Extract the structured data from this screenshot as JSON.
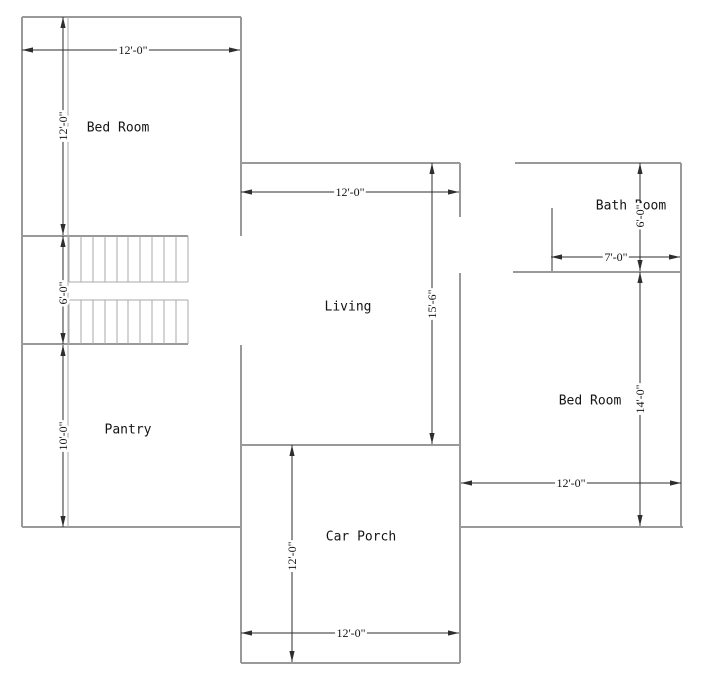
{
  "plan": {
    "rooms": {
      "bed_left": "Bed Room",
      "pantry": "Pantry",
      "living": "Living",
      "car_porch": "Car Porch",
      "bath": "Bath Room",
      "bed_right": "Bed Room"
    },
    "dims": {
      "top_left_width": "12'-0\"",
      "bed_left_height": "12'-0\"",
      "stairs_height": "6'-0\"",
      "pantry_height": "10'-0\"",
      "living_width": "12'-0\"",
      "living_height": "15'-6\"",
      "bath_height": "6'-0\"",
      "bath_width": "7'-0\"",
      "bed_right_height": "14'-0\"",
      "bed_right_width": "12'-0\"",
      "car_porch_height": "12'-0\"",
      "car_porch_width": "12'-0\""
    },
    "colors": {
      "wall": "#999999",
      "wall_light": "#aaaaaa",
      "dimension": "#2e2e2e",
      "text": "#141414",
      "background": "#ffffff"
    }
  }
}
